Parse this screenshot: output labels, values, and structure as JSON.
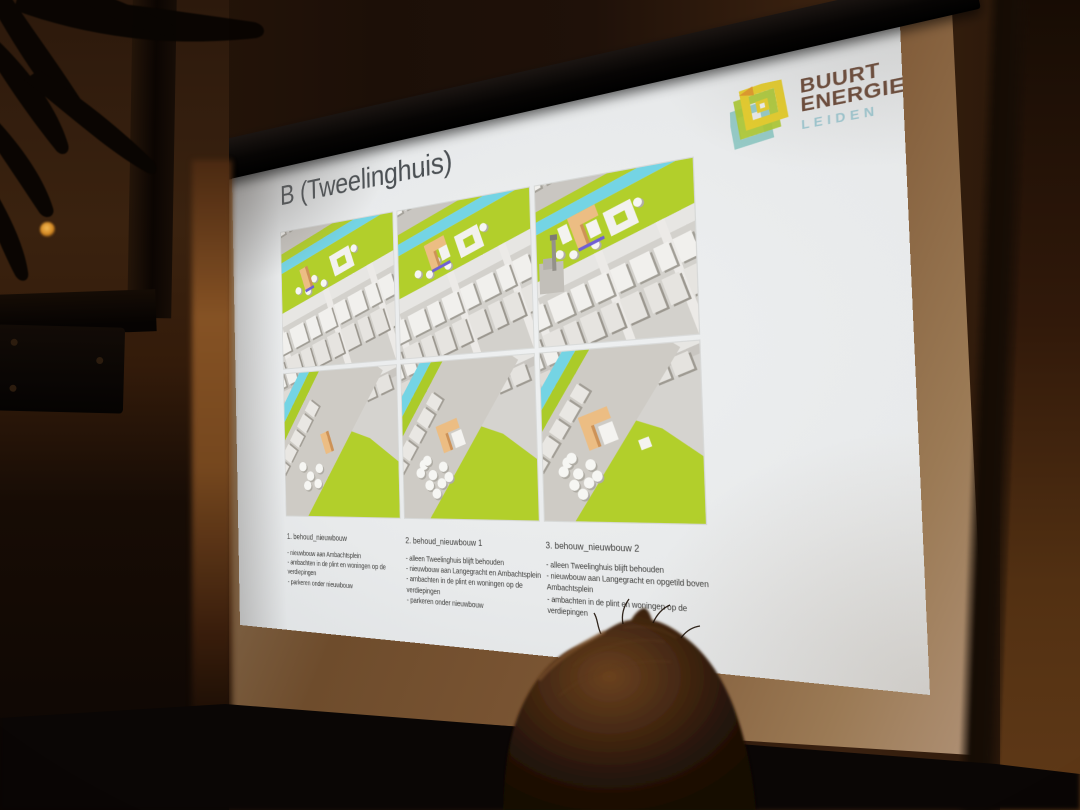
{
  "slide": {
    "title": "B (Tweelinghuis)",
    "logo": {
      "line1": "BUURT",
      "line2": "ENERGIE",
      "line3": "LEIDEN"
    },
    "options": [
      {
        "heading": "1. behoud_nieuwbouw",
        "bullets": [
          "- nieuwbouw aan Ambachtsplein",
          "- ambachten in de plint en woningen op de verdiepingen",
          "- parkeren onder nieuwbouw"
        ]
      },
      {
        "heading": "2. behoud_nieuwbouw 1",
        "bullets": [
          "- alleen Tweelinghuis blijft behouden",
          "- nieuwbouw aan Langegracht en Ambachtsplein",
          "- ambachten in de plint en woningen op de verdiepingen",
          "- parkeren onder nieuwbouw"
        ]
      },
      {
        "heading": "3. behouw_nieuwbouw 2",
        "bullets": [
          "- alleen Tweelinghuis blijft behouden",
          "- nieuwbouw aan Langegracht en opgetild boven Ambachtsplein",
          "- ambachten in de plint en woningen op de verdiepingen"
        ]
      }
    ],
    "colors": {
      "park": "#b2cf2b",
      "water": "#74d4e4",
      "highlight": "#ecbd83",
      "highlight_side": "#cd9257",
      "accent_purple": "#6f5fd5",
      "building": "#f1f0ed",
      "building_shade": "#a5a29a",
      "road": "#e7e6e3",
      "logo_brown": "#6b4a39",
      "logo_teal": "#9fc8d1",
      "logo_yellow": "#e5cd2e",
      "logo_lime": "#abc832",
      "logo_cyan": "#8cc7c2",
      "logo_orange": "#e09a2c",
      "title_color": "#4b5054",
      "text_color": "#3e3e3c"
    }
  }
}
